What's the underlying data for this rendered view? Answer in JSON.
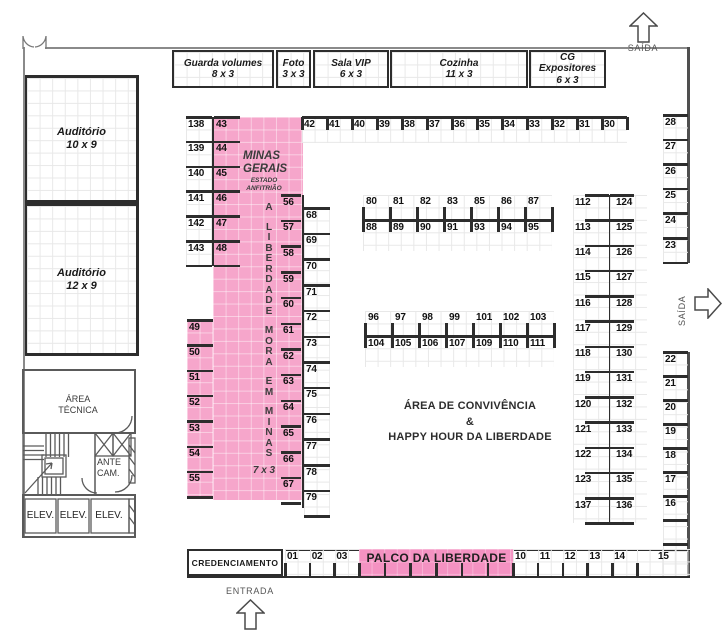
{
  "colors": {
    "pink": "#F6A6CB",
    "palco_pink": "#F492C2",
    "line_dark": "#2d2d2d",
    "wall_gray": "#8a8a8a"
  },
  "signs": {
    "saida_top": "SAÍDA",
    "saida_right": "SAÍDA",
    "entrada": "ENTRADA",
    "credenciamento": "CREDENCIAMENTO",
    "palco": "PALCO DA LIBERDADE",
    "convivencia": {
      "line1": "ÁREA DE CONVIVÊNCIA",
      "line2": "&",
      "line3": "HAPPY HOUR DA LIBERDADE"
    }
  },
  "rooms": {
    "top": [
      {
        "name": "Guarda volumes",
        "size": "8 x 3"
      },
      {
        "name": "Foto",
        "size": "3 x 3"
      },
      {
        "name": "Sala VIP",
        "size": "6 x 3"
      },
      {
        "name": "Cozinha",
        "size": "11 x 3"
      },
      {
        "name": "CG Expositores",
        "size": "6 x 3"
      }
    ],
    "auditorio_1": {
      "name": "Auditório",
      "size": "10 x 9"
    },
    "auditorio_2": {
      "name": "Auditório",
      "size": "12 x 9"
    },
    "area_tecnica": {
      "line1": "ÁREA",
      "line2": "TÉCNICA"
    },
    "ante_cam": {
      "line1": "ANTE",
      "line2": "CAM."
    },
    "elevators": [
      "ELEV.",
      "ELEV.",
      "ELEV."
    ]
  },
  "minas": {
    "title": "MINAS GERAIS",
    "subtitle": "ESTADO ANFITRIÃO",
    "vertical_words": [
      "A",
      "LIBERDADE",
      "MORA",
      "EM",
      "MINAS"
    ],
    "size_label": "7 x 3"
  },
  "booths": {
    "top_row": [
      "42",
      "41",
      "40",
      "39",
      "38",
      "37",
      "36",
      "35",
      "34",
      "33",
      "32",
      "31",
      "30"
    ],
    "left_outer": [
      "138",
      "139",
      "140",
      "141",
      "142",
      "143"
    ],
    "left_inner": [
      "43",
      "44",
      "45",
      "46",
      "47",
      "48"
    ],
    "col49": [
      "49",
      "50",
      "51",
      "52",
      "53",
      "54",
      "55"
    ],
    "col56": [
      "56",
      "57",
      "58",
      "59",
      "60",
      "61",
      "62",
      "63",
      "64",
      "65",
      "66",
      "67"
    ],
    "col68": [
      "68",
      "69",
      "70",
      "71",
      "72",
      "73",
      "74",
      "75",
      "76",
      "77",
      "78",
      "79"
    ],
    "island1_top": [
      "80",
      "81",
      "82",
      "83",
      "85",
      "86",
      "87"
    ],
    "island1_bottom": [
      "88",
      "89",
      "90",
      "91",
      "93",
      "94",
      "95"
    ],
    "island2_top": [
      "96",
      "97",
      "98",
      "99",
      "101",
      "102",
      "103"
    ],
    "island2_bottom": [
      "104",
      "105",
      "106",
      "107",
      "109",
      "110",
      "111"
    ],
    "right_col_left": [
      "112",
      "113",
      "114",
      "115",
      "116",
      "117",
      "118",
      "119",
      "120",
      "121",
      "122",
      "123",
      "137"
    ],
    "right_col_right": [
      "124",
      "125",
      "126",
      "127",
      "128",
      "129",
      "130",
      "131",
      "132",
      "133",
      "134",
      "135",
      "136"
    ],
    "wall_top": [
      "28",
      "27",
      "26",
      "25",
      "24",
      "23"
    ],
    "wall_bottom": [
      "22",
      "21",
      "20",
      "19",
      "18",
      "17",
      "16"
    ],
    "bottom_left": [
      "01",
      "02",
      "03"
    ],
    "bottom_right": [
      "10",
      "11",
      "12",
      "13",
      "14"
    ],
    "corner": "15"
  }
}
